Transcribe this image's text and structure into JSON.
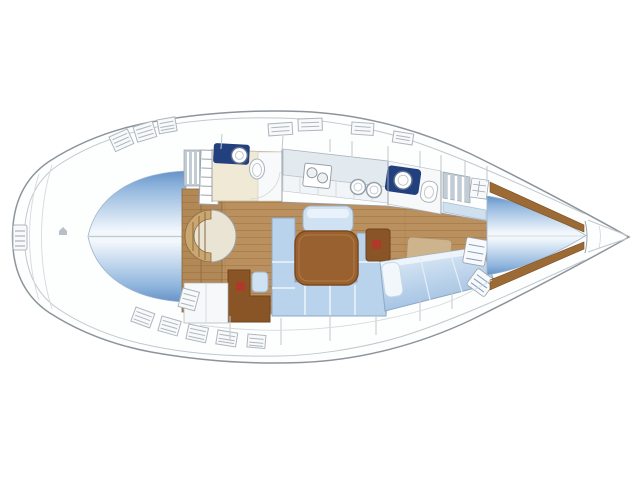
{
  "canvas": {
    "width": 640,
    "height": 479,
    "background": "#ffffff"
  },
  "diagram": {
    "kind": "sailing-yacht-interior-layout-plan",
    "orientation": "bow-right-stern-left",
    "text_labels": [],
    "regions": [
      "aft-double-berth",
      "companionway-steps",
      "curved-seat",
      "aft-head",
      "galley",
      "forward-head",
      "saloon",
      "nav-station",
      "u-settee",
      "saloon-table",
      "starboard-cabin-berth",
      "v-berth-cabin",
      "anchor-locker",
      "side-decks",
      "swim-ladder"
    ]
  },
  "colors": {
    "hull_fill": "#fdfefe",
    "hull_outline": "#8d949b",
    "rim_line": "#c6ccd2",
    "berth_edge": "#6592c7",
    "berth_mid": "#8fb5dd",
    "berth_center": "#f2f7fc",
    "diag_berth_light": "#e8f1f9",
    "diag_berth_dark": "#9fc0e2",
    "settee": "#b9d3ed",
    "settee_line": "#8fa8c4",
    "bench": "#cfe2f4",
    "wood_floor": "#b9905e",
    "wood_plank_line": "#a67c4b",
    "wood_trim": "#9c6a35",
    "table_wood": "#9a6130",
    "nav_wood": "#8a5526",
    "seat_wood": "#c9a76f",
    "seat_cushion": "#eae4d4",
    "head_floor": "#efe9d6",
    "vanity_navy": "#23407e",
    "counter": "#e3eaef",
    "cabinet_white": "#f2f5f7",
    "locker_stripe_bg": "#c2ccd5",
    "accent_red": "#b03a2a",
    "tan_step": "#cdb48c",
    "hatch_fill": "#f7f9fa",
    "hatch_line": "#aeb6bd",
    "shelf_blue": "#cfe0ef"
  }
}
